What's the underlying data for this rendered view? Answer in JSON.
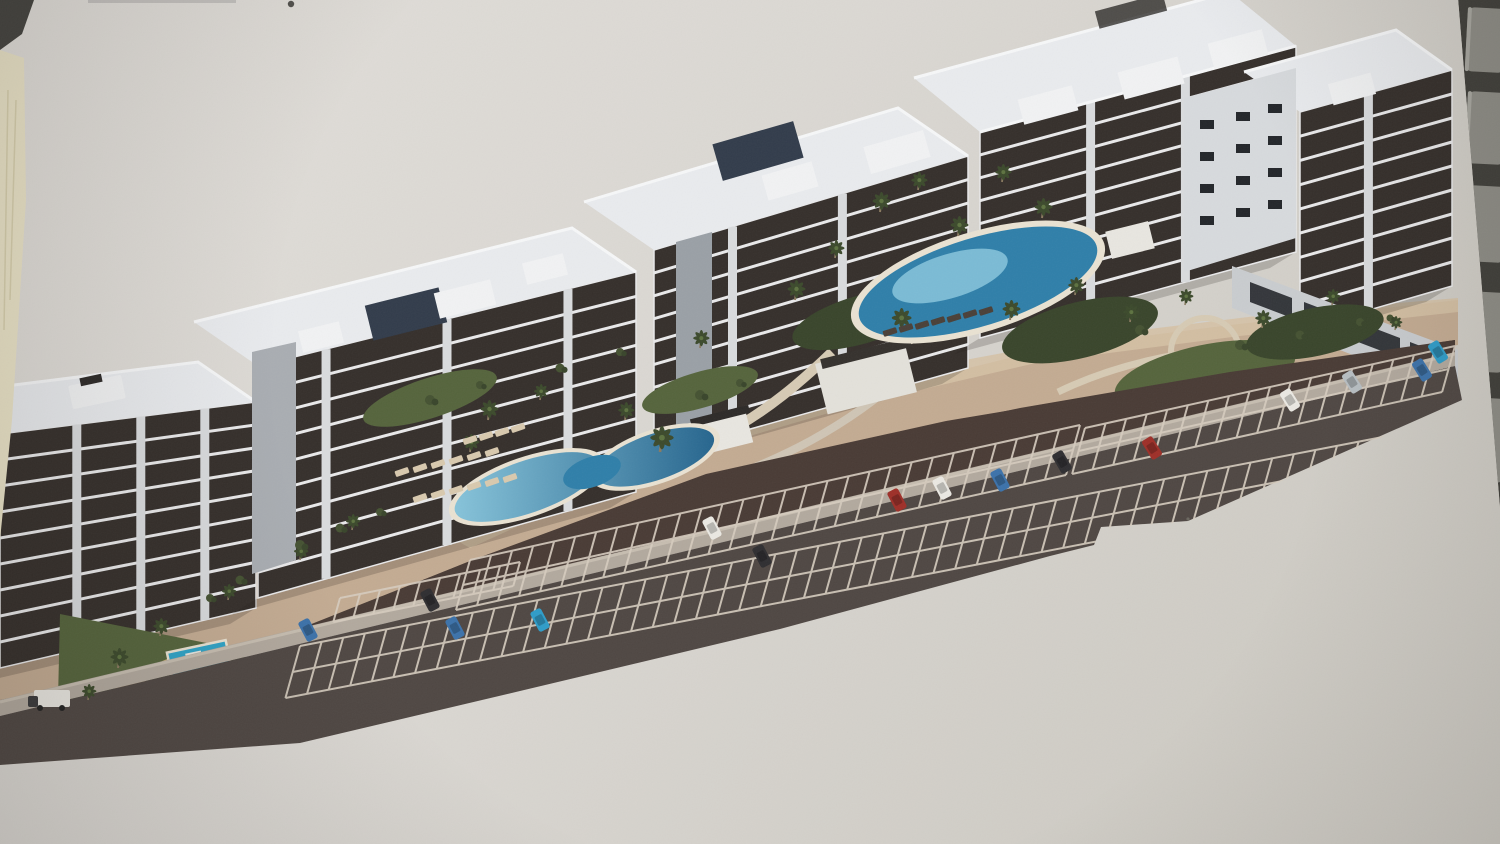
{
  "caption": "Photograph of a printed aerial architectural rendering of a seaside apartment complex with five white residential blocks, rooftop terraces, swimming pools, palm-tree gardens and a large angled parking lot, lying on a desk with a laptop keyboard edge visible at the top right and a cream paper strip at the left",
  "palette": {
    "paper": "#dbd8d3",
    "paperLight": "#e1ded9",
    "paperDark": "#cfccc5",
    "cream": "#ebe4c8",
    "creamLine": "#d8d0ae",
    "kbGap": "#403f3a",
    "kbKey": "#8d8c85",
    "kbKeyHi": "#a7a69f",
    "mark": "#44433f",
    "faintLine": "#bdbbb8",
    "fac": "#352f2b",
    "slab": "#e9e9ea",
    "pier": "#d9dbdd",
    "roof": "#e9ebee",
    "railing": "#f6f7f8",
    "box": "#f1f2f3",
    "boxDark": "#2d2a28",
    "pergola": "#323c4b",
    "sideWall": "#b6babe",
    "panelLight": "#d7dadd",
    "baseWall": "#c9cccf",
    "winDark": "#23262a",
    "deck": "#c3ab92",
    "deckLight": "#d5c1a4",
    "sand": "#d9b87c",
    "asphalt": "#493b35",
    "road": "#4f4743",
    "sidewalk": "#b2a99e",
    "curb": "#c6bdb0",
    "pline": "#d6ccbf",
    "pool": "#2f7fa9",
    "poolLight": "#8ecbe0",
    "poolRim": "#e9e2d2",
    "kidsPool": "#2fa3c6",
    "green": "#55643c",
    "greenDark": "#39452b",
    "lawn": "#7aa43e",
    "shrub": "#455232",
    "palm": "#3c4a2c",
    "palmLight": "#5d7240",
    "trunk": "#8a7a60",
    "pathLight": "#d6cab4",
    "carWhite": "#eae8e2",
    "carBlue": "#3c72aa",
    "carCyan": "#2f9cc8",
    "carRed": "#9e2f28",
    "carDark": "#2f2e31",
    "carSilver": "#b7bec2",
    "loungerLight": "#d8c9ae",
    "loungerDark": "#4a4038",
    "shadow": "#241f1b"
  },
  "buildings": [
    {
      "name": "block-a",
      "facade": [
        [
          0,
          434
        ],
        [
          256,
          402
        ],
        [
          256,
          608
        ],
        [
          0,
          668
        ]
      ],
      "slabs": 8,
      "piers": [
        0.3,
        0.55,
        0.8
      ]
    },
    {
      "name": "block-b",
      "facade": [
        [
          258,
          366
        ],
        [
          636,
          272
        ],
        [
          636,
          492
        ],
        [
          258,
          598
        ]
      ],
      "slabs": 8,
      "piers": [
        0.18,
        0.5,
        0.82
      ]
    },
    {
      "name": "block-c",
      "facade": [
        [
          654,
          250
        ],
        [
          968,
          156
        ],
        [
          968,
          368
        ],
        [
          654,
          456
        ]
      ],
      "slabs": 8,
      "piers": [
        0.25,
        0.6
      ]
    },
    {
      "name": "block-d",
      "facade": [
        [
          980,
          132
        ],
        [
          1296,
          46
        ],
        [
          1296,
          252
        ],
        [
          980,
          338
        ]
      ],
      "slabs": 8,
      "piers": [
        0.35,
        0.65
      ]
    },
    {
      "name": "block-e",
      "facade": [
        [
          1300,
          112
        ],
        [
          1452,
          70
        ],
        [
          1452,
          286
        ],
        [
          1300,
          330
        ]
      ],
      "slabs": 8,
      "piers": [
        0.45
      ]
    }
  ],
  "parking": {
    "bands": [
      {
        "x1": 470,
        "y1": 560,
        "x2": 1080,
        "y2": 425,
        "h": 50,
        "gap": 21,
        "double": true
      },
      {
        "x1": 300,
        "y1": 646,
        "x2": 1445,
        "y2": 425,
        "h": 52,
        "gap": 22,
        "double": true
      },
      {
        "x1": 1085,
        "y1": 428,
        "x2": 1455,
        "y2": 346,
        "h": 46,
        "gap": 20,
        "double": true
      },
      {
        "x1": 340,
        "y1": 598,
        "x2": 520,
        "y2": 562,
        "h": 24,
        "gap": 20,
        "double": false
      }
    ]
  },
  "cars": [
    {
      "x": 308,
      "y": 630,
      "r": 62,
      "c": "carBlue"
    },
    {
      "x": 430,
      "y": 600,
      "r": 62,
      "c": "carDark"
    },
    {
      "x": 455,
      "y": 628,
      "r": 62,
      "c": "carBlue"
    },
    {
      "x": 540,
      "y": 620,
      "r": 62,
      "c": "carCyan"
    },
    {
      "x": 712,
      "y": 528,
      "r": 62,
      "c": "carWhite"
    },
    {
      "x": 762,
      "y": 556,
      "r": 62,
      "c": "carDark"
    },
    {
      "x": 897,
      "y": 500,
      "r": 62,
      "c": "carRed"
    },
    {
      "x": 942,
      "y": 488,
      "r": 62,
      "c": "carWhite"
    },
    {
      "x": 1000,
      "y": 480,
      "r": 62,
      "c": "carBlue"
    },
    {
      "x": 1062,
      "y": 462,
      "r": 60,
      "c": "carDark"
    },
    {
      "x": 1152,
      "y": 448,
      "r": 58,
      "c": "carRed"
    },
    {
      "x": 1290,
      "y": 400,
      "r": 58,
      "c": "carWhite"
    },
    {
      "x": 1352,
      "y": 382,
      "r": 58,
      "c": "carSilver"
    },
    {
      "x": 1422,
      "y": 370,
      "r": 58,
      "c": "carBlue"
    },
    {
      "x": 1438,
      "y": 352,
      "r": 58,
      "c": "carCyan"
    }
  ],
  "sprites": [
    {
      "id": "palm",
      "x": 118,
      "y": 668,
      "s": 1.0
    },
    {
      "id": "palm",
      "x": 88,
      "y": 700,
      "s": 0.8
    },
    {
      "id": "palm",
      "x": 160,
      "y": 636,
      "s": 0.9
    },
    {
      "id": "palm",
      "x": 228,
      "y": 600,
      "s": 0.8
    },
    {
      "id": "palm",
      "x": 488,
      "y": 420,
      "s": 1.0
    },
    {
      "id": "palm",
      "x": 540,
      "y": 400,
      "s": 0.8
    },
    {
      "id": "palm",
      "x": 470,
      "y": 452,
      "s": 0.9
    },
    {
      "id": "palm",
      "x": 660,
      "y": 452,
      "s": 1.3
    },
    {
      "id": "palm",
      "x": 625,
      "y": 420,
      "s": 0.9
    },
    {
      "id": "palm",
      "x": 700,
      "y": 348,
      "s": 0.9
    },
    {
      "id": "palm",
      "x": 795,
      "y": 300,
      "s": 1.0
    },
    {
      "id": "palm",
      "x": 835,
      "y": 258,
      "s": 0.9
    },
    {
      "id": "palm",
      "x": 880,
      "y": 212,
      "s": 1.0
    },
    {
      "id": "palm",
      "x": 918,
      "y": 190,
      "s": 0.9
    },
    {
      "id": "palm",
      "x": 958,
      "y": 236,
      "s": 1.0
    },
    {
      "id": "palm",
      "x": 1002,
      "y": 182,
      "s": 0.9
    },
    {
      "id": "palm",
      "x": 1042,
      "y": 218,
      "s": 1.0
    },
    {
      "id": "palm",
      "x": 900,
      "y": 330,
      "s": 1.1
    },
    {
      "id": "palm",
      "x": 1010,
      "y": 320,
      "s": 1.0
    },
    {
      "id": "palm",
      "x": 1075,
      "y": 295,
      "s": 0.9
    },
    {
      "id": "palm",
      "x": 1130,
      "y": 322,
      "s": 0.9
    },
    {
      "id": "palm",
      "x": 1185,
      "y": 305,
      "s": 0.8
    },
    {
      "id": "palm",
      "x": 1262,
      "y": 328,
      "s": 0.9
    },
    {
      "id": "palm",
      "x": 1332,
      "y": 305,
      "s": 0.8
    },
    {
      "id": "palm",
      "x": 1395,
      "y": 330,
      "s": 0.7
    },
    {
      "id": "palm",
      "x": 300,
      "y": 560,
      "s": 0.8
    },
    {
      "id": "palm",
      "x": 352,
      "y": 530,
      "s": 0.8
    },
    {
      "id": "shrub",
      "x": 430,
      "y": 400,
      "s": 1
    },
    {
      "id": "shrub",
      "x": 480,
      "y": 385,
      "s": 0.8
    },
    {
      "id": "shrub",
      "x": 560,
      "y": 368,
      "s": 0.9
    },
    {
      "id": "shrub",
      "x": 620,
      "y": 352,
      "s": 0.8
    },
    {
      "id": "shrub",
      "x": 300,
      "y": 545,
      "s": 1
    },
    {
      "id": "shrub",
      "x": 340,
      "y": 528,
      "s": 0.9
    },
    {
      "id": "shrub",
      "x": 380,
      "y": 512,
      "s": 0.8
    },
    {
      "id": "shrub",
      "x": 700,
      "y": 395,
      "s": 1
    },
    {
      "id": "shrub",
      "x": 740,
      "y": 383,
      "s": 0.8
    },
    {
      "id": "shrub",
      "x": 1140,
      "y": 330,
      "s": 1
    },
    {
      "id": "shrub",
      "x": 1240,
      "y": 345,
      "s": 1
    },
    {
      "id": "shrub",
      "x": 1300,
      "y": 335,
      "s": 0.9
    },
    {
      "id": "shrub",
      "x": 1360,
      "y": 322,
      "s": 0.8
    },
    {
      "id": "shrub",
      "x": 240,
      "y": 580,
      "s": 0.9
    },
    {
      "id": "shrub",
      "x": 210,
      "y": 598,
      "s": 0.8
    },
    {
      "id": "shrub",
      "x": 1390,
      "y": 318,
      "s": 0.7
    },
    {
      "id": "lounger-light",
      "x": 402,
      "y": 472,
      "r": -19
    },
    {
      "id": "lounger-light",
      "x": 420,
      "y": 468,
      "r": -19
    },
    {
      "id": "lounger-light",
      "x": 438,
      "y": 464,
      "r": -19
    },
    {
      "id": "lounger-light",
      "x": 456,
      "y": 460,
      "r": -19
    },
    {
      "id": "lounger-light",
      "x": 474,
      "y": 456,
      "r": -19
    },
    {
      "id": "lounger-light",
      "x": 492,
      "y": 452,
      "r": -19
    },
    {
      "id": "lounger-light",
      "x": 420,
      "y": 498,
      "r": -19
    },
    {
      "id": "lounger-light",
      "x": 438,
      "y": 494,
      "r": -19
    },
    {
      "id": "lounger-light",
      "x": 456,
      "y": 490,
      "r": -19
    },
    {
      "id": "lounger-light",
      "x": 474,
      "y": 486,
      "r": -19
    },
    {
      "id": "lounger-light",
      "x": 492,
      "y": 482,
      "r": -19
    },
    {
      "id": "lounger-light",
      "x": 510,
      "y": 478,
      "r": -19
    },
    {
      "id": "lounger-light",
      "x": 470,
      "y": 440,
      "r": -19
    },
    {
      "id": "lounger-light",
      "x": 486,
      "y": 436,
      "r": -19
    },
    {
      "id": "lounger-light",
      "x": 502,
      "y": 432,
      "r": -19
    },
    {
      "id": "lounger-light",
      "x": 518,
      "y": 428,
      "r": -19
    },
    {
      "id": "lounger-dark",
      "x": 890,
      "y": 332,
      "r": -17
    },
    {
      "id": "lounger-dark",
      "x": 906,
      "y": 328,
      "r": -17
    },
    {
      "id": "lounger-dark",
      "x": 922,
      "y": 325,
      "r": -17
    },
    {
      "id": "lounger-dark",
      "x": 938,
      "y": 321,
      "r": -17
    },
    {
      "id": "lounger-dark",
      "x": 954,
      "y": 318,
      "r": -17
    },
    {
      "id": "lounger-dark",
      "x": 970,
      "y": 314,
      "r": -17
    },
    {
      "id": "lounger-dark",
      "x": 986,
      "y": 311,
      "r": -17
    }
  ],
  "keyboard": {
    "keys": [
      [
        8,
        64
      ],
      [
        92,
        72
      ],
      [
        186,
        76
      ],
      [
        292,
        80
      ],
      [
        398,
        84
      ]
    ]
  }
}
